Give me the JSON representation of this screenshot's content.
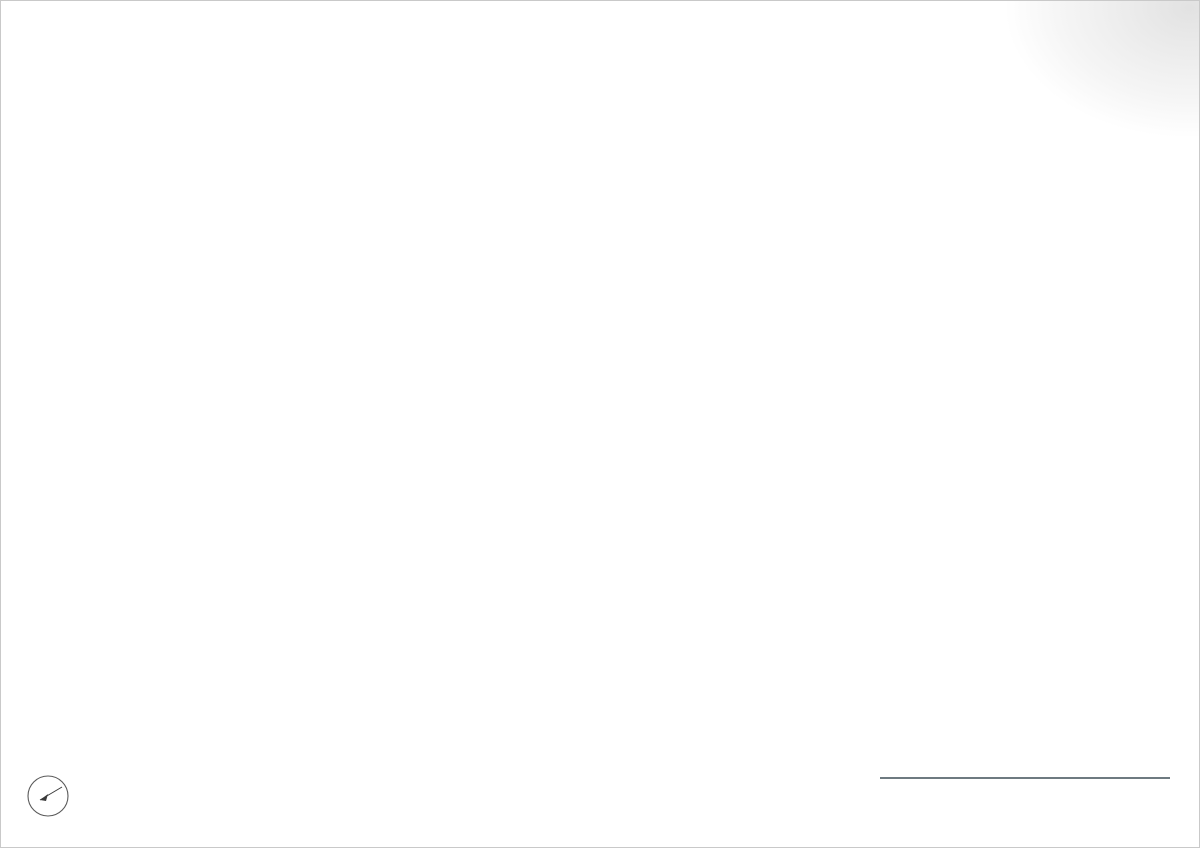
{
  "titlebar": {
    "title": "Lay out",
    "north_letter": "N"
  },
  "titleblock": {
    "scale_label": "Escala gráfica",
    "format_label": "Formato A3",
    "scale_value": "1/200"
  },
  "disclaimer": {
    "line1": "Este documento (tanto su parte gráfica como los datos referidos a superficies) tiene carácter meramente orientativo, sin perjuicio de la información más exacta contenida en la documentación técnica del edificio. Todo el mobiliario que se muestra en este",
    "line2": "plano, incluido el de la cocina, se ha incluido a efectos meramente orientativos y decorativos. Las superficies expresadas son aproximadas, pudiendo experimentar modificaciones por razones de índole técnica en el desarrollo de la ejecución de las obras"
  },
  "drawing": {
    "type": "architectural-site-plan",
    "colors": {
      "paper": "#ffffff",
      "page_border": "#c9c9c9",
      "contour_major": "#1c1c1c",
      "contour_minor": "#9b9b9b",
      "road_hatch": "#c2c6c3",
      "road_edge": "#8a8f8c",
      "boundary_gray": "#b3b3b3",
      "wall": "#63676a",
      "furniture": "#8f9496",
      "lawn": "#8cb645",
      "lawn_dot": "#5e7d28",
      "tree_fill": "#8d986b",
      "tree_edge": "#6f7a52",
      "palm": "#a6bab8",
      "terrace": "#e7e9e7",
      "terrace_dash": "#a6aaa6",
      "court_bg": "#f1f2f0",
      "court_grid": "#d3d6d2",
      "pool_bg": "#f7f8f6",
      "pool_grid": "#dcdfdc",
      "titleblock_rule": "#3e4e56"
    }
  }
}
